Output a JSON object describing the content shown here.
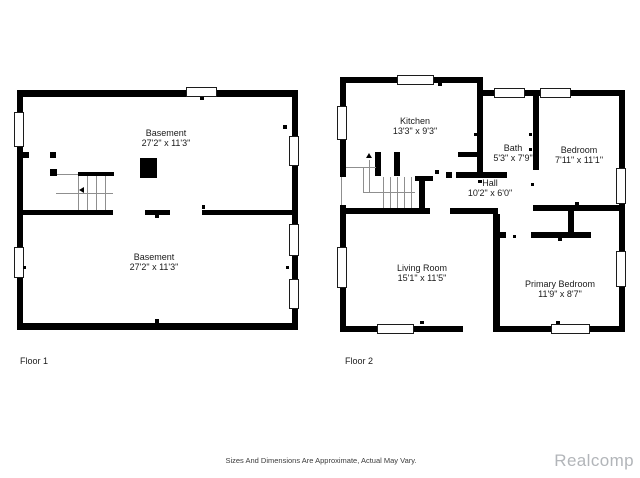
{
  "floor1": {
    "label": "Floor 1",
    "rooms": [
      {
        "name": "Basement",
        "dims": "27'2\" x 11'3\""
      },
      {
        "name": "Basement",
        "dims": "27'2\" x 11'3\""
      }
    ]
  },
  "floor2": {
    "label": "Floor 2",
    "rooms": {
      "kitchen": {
        "name": "Kitchen",
        "dims": "13'3\" x 9'3\""
      },
      "bath": {
        "name": "Bath",
        "dims": "5'3\" x 7'9\""
      },
      "bedroom": {
        "name": "Bedroom",
        "dims": "7'11\" x 11'1\""
      },
      "hall": {
        "name": "Hall",
        "dims": "10'2\" x 6'0\""
      },
      "living_room": {
        "name": "Living Room",
        "dims": "15'1\" x 11'5\""
      },
      "primary_bedroom": {
        "name": "Primary Bedroom",
        "dims": "11'9\" x 8'7\""
      }
    }
  },
  "footer": {
    "disclaimer": "Sizes And Dimensions Are Approximate, Actual May Vary.",
    "watermark": "Realcomp"
  },
  "colors": {
    "wall": "#000000",
    "thin_line": "#8f8f8f",
    "text": "#1a1a1a",
    "watermark": "#b2b5b9",
    "background": "#ffffff"
  }
}
